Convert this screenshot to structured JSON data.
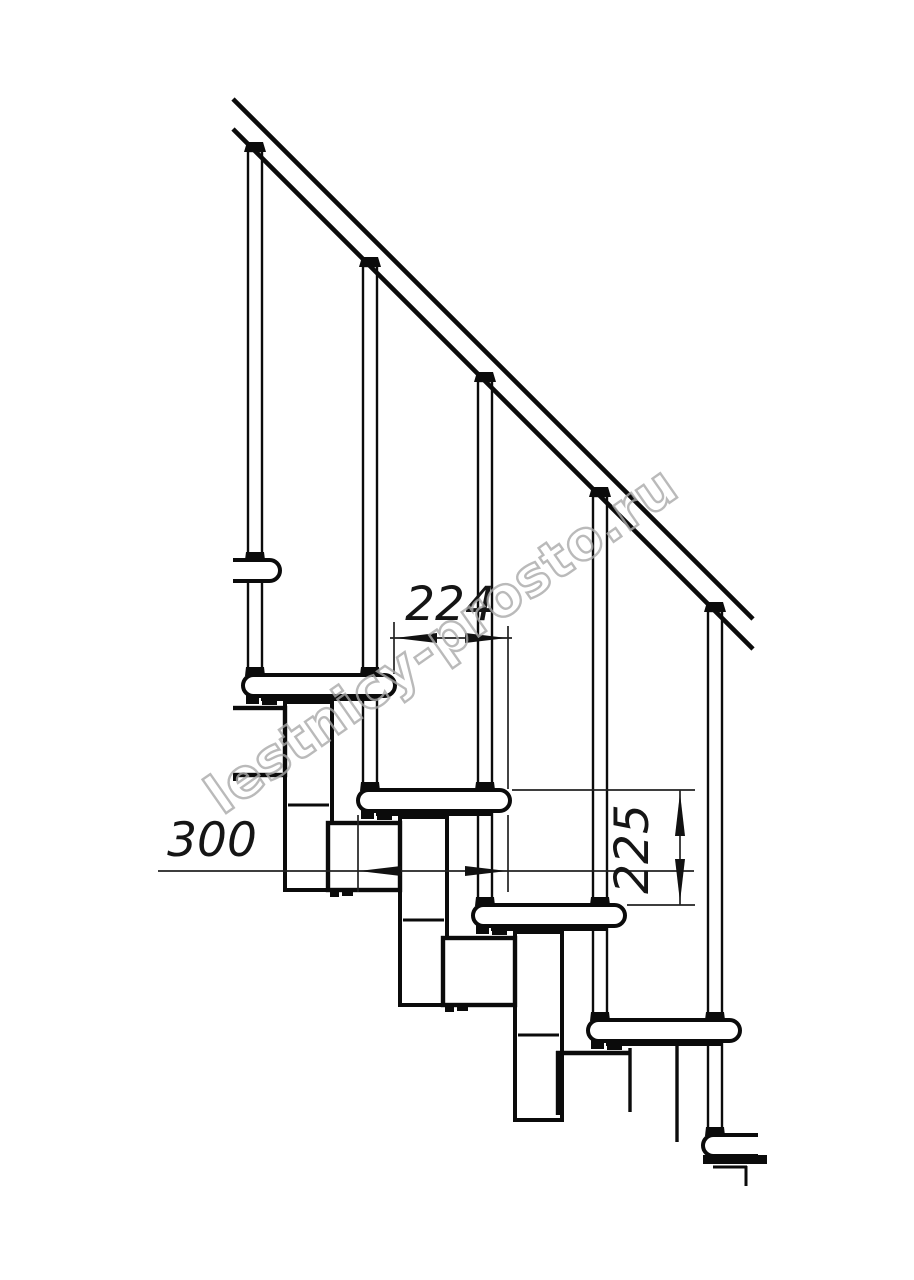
{
  "watermark": {
    "text": "lestnicy-prosto.ru",
    "color": "#a9a9a9"
  },
  "dimensions": {
    "run_label": "224",
    "tread_depth_label": "300",
    "rise_label": "225"
  },
  "structure": {
    "treads_visible": 6,
    "balusters_visible": 5,
    "ink_color": "#0b0b0b"
  }
}
